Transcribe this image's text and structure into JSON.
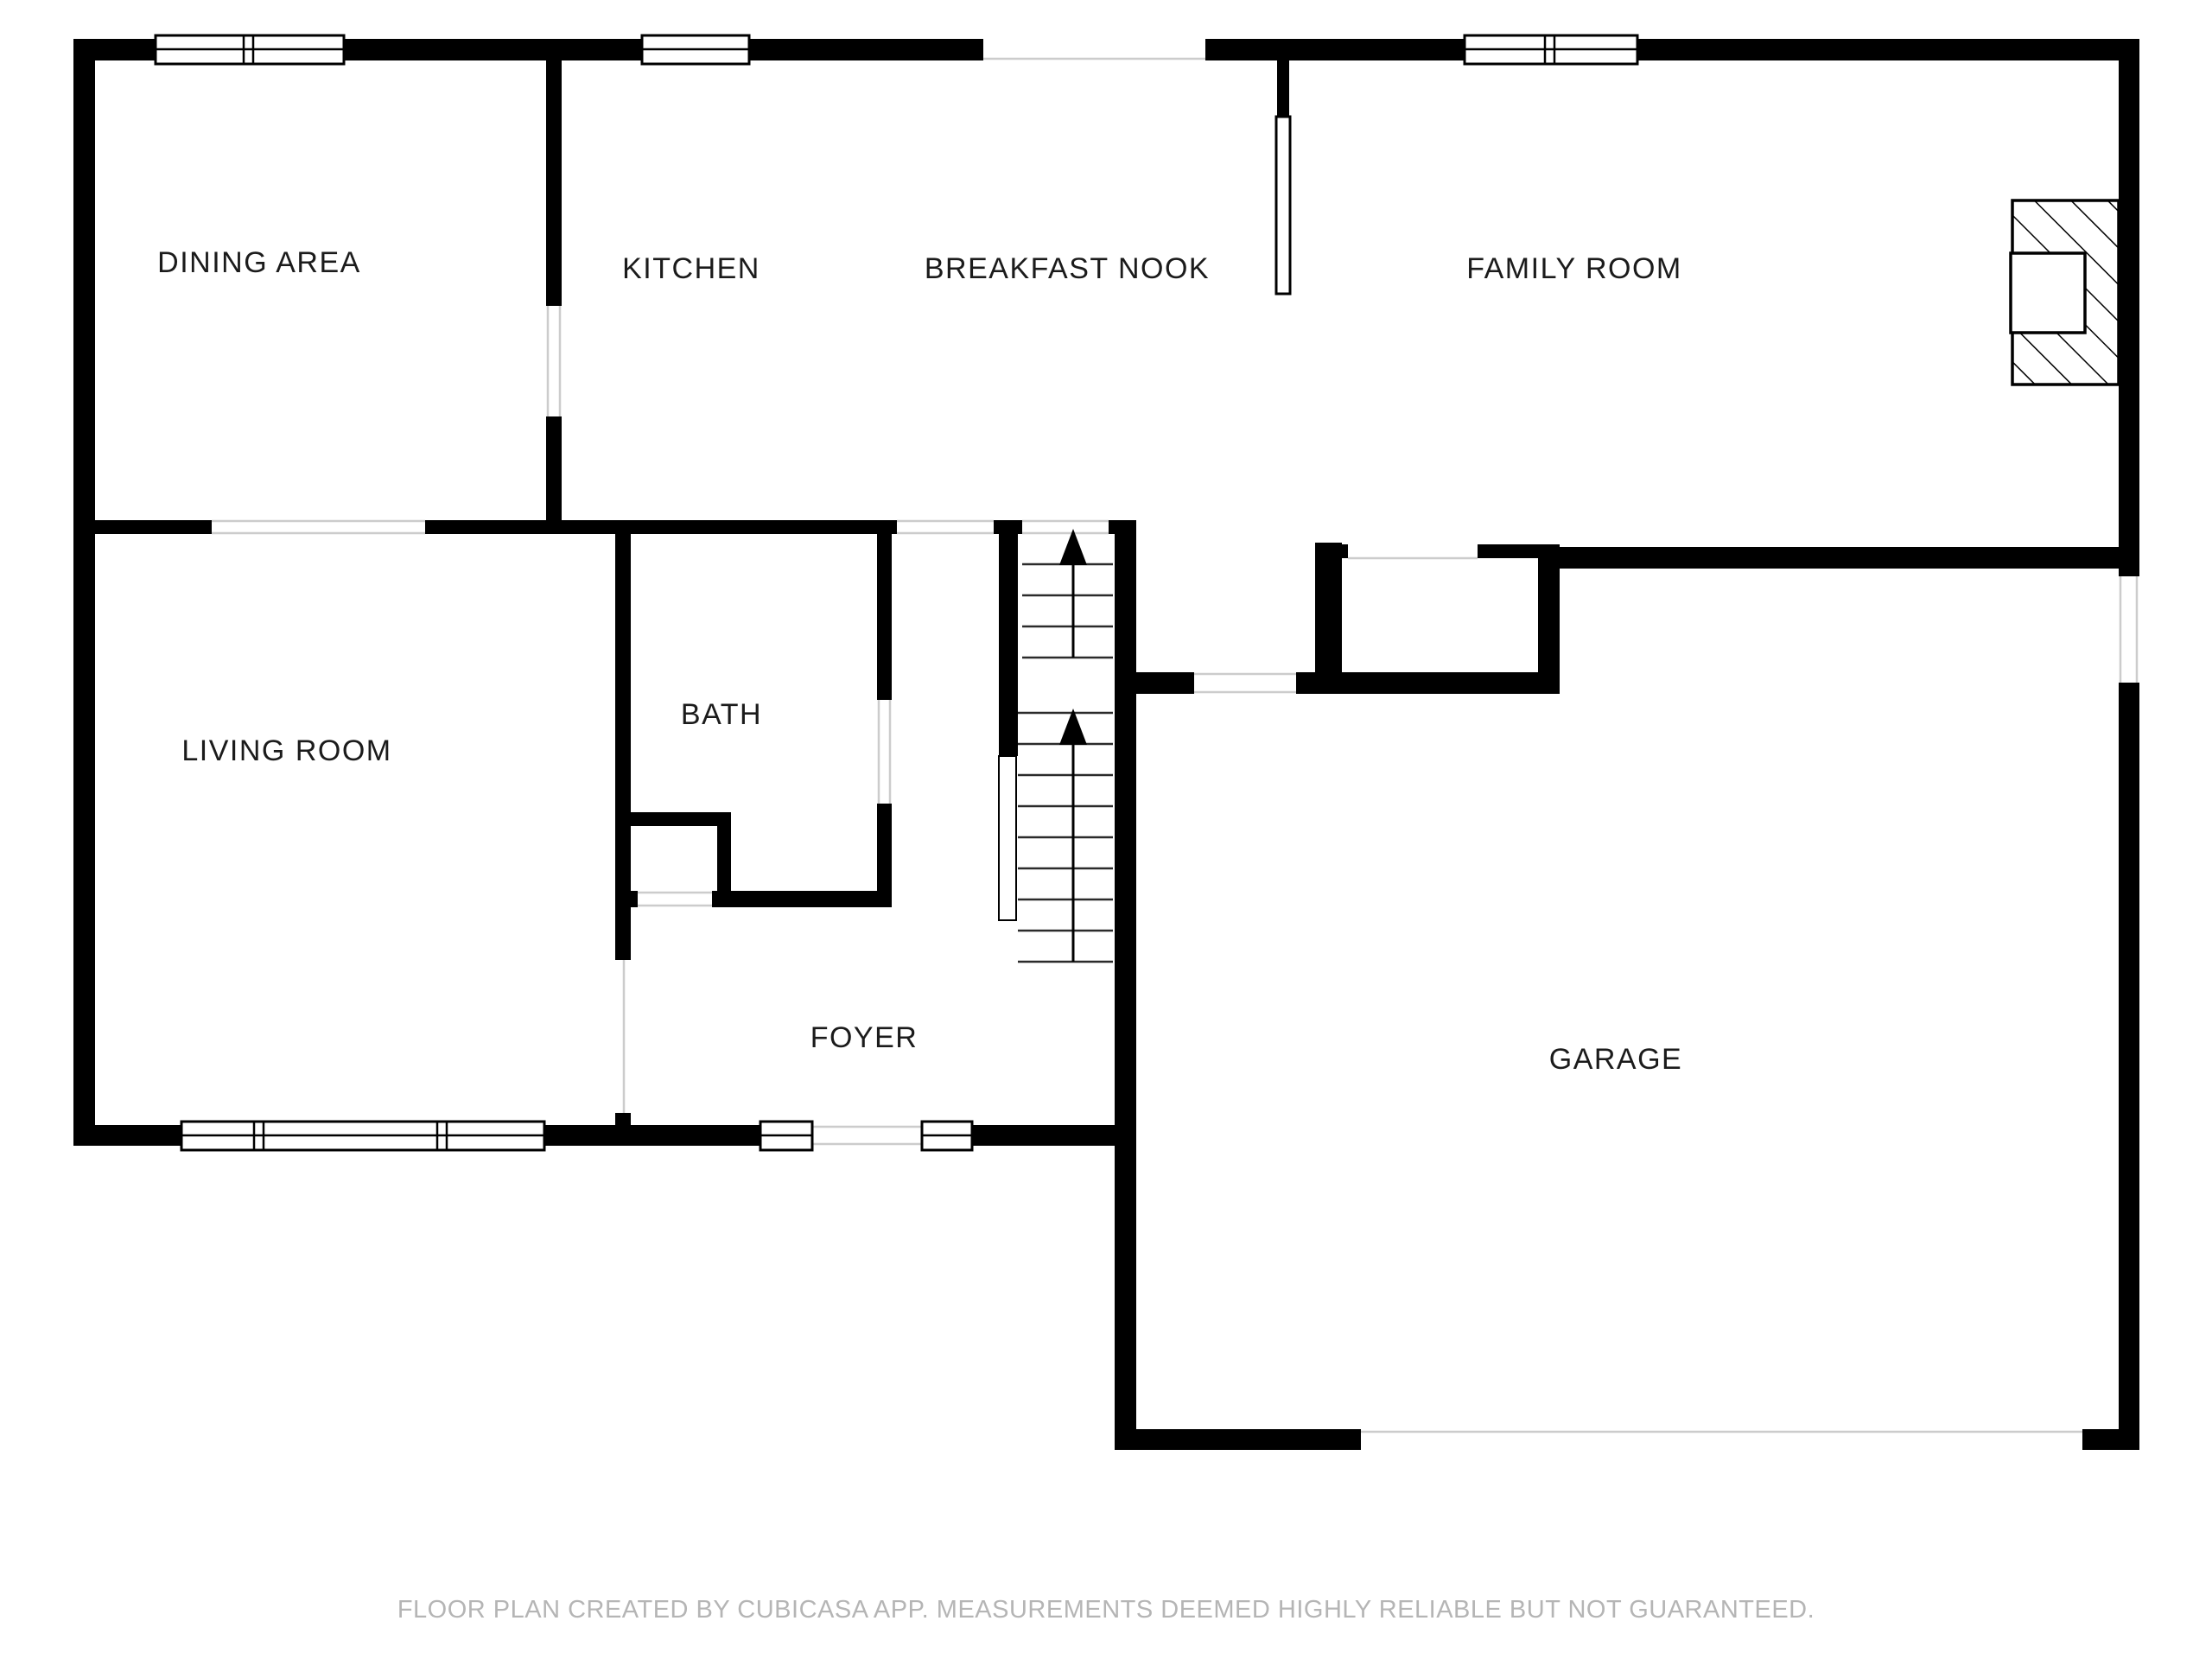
{
  "document": {
    "type": "floor-plan",
    "creator_note": "FLOOR PLAN CREATED BY CUBICASA APP. MEASUREMENTS DEEMED HIGHLY RELIABLE BUT NOT GUARANTEED."
  },
  "colors": {
    "wall": "#000000",
    "background": "#ffffff",
    "opening_line": "#cccccc",
    "label": "#1b1b1b",
    "footer": "#b5b5b5"
  },
  "rooms": [
    {
      "id": "dining-area",
      "label": "DINING AREA"
    },
    {
      "id": "kitchen",
      "label": "KITCHEN"
    },
    {
      "id": "breakfast-nook",
      "label": "BREAKFAST NOOK"
    },
    {
      "id": "family-room",
      "label": "FAMILY ROOM"
    },
    {
      "id": "living-room",
      "label": "LIVING ROOM"
    },
    {
      "id": "bath",
      "label": "BATH"
    },
    {
      "id": "foyer",
      "label": "FOYER"
    },
    {
      "id": "garage",
      "label": "GARAGE"
    }
  ],
  "features": {
    "stairs": {
      "flights": 2,
      "up_arrows": 2
    },
    "fireplace": {
      "location": "family-room-right-wall",
      "style": "hatched"
    },
    "windows": 8,
    "door_openings": [
      "front-door",
      "dining-kitchen",
      "dining-living",
      "bath",
      "bath-foyer",
      "garage-hall",
      "closet",
      "garage-door",
      "patio-opening",
      "family-side-opening"
    ]
  },
  "footer": {
    "text": "FLOOR PLAN CREATED BY CUBICASA APP. MEASUREMENTS DEEMED HIGHLY RELIABLE BUT NOT GUARANTEED."
  }
}
